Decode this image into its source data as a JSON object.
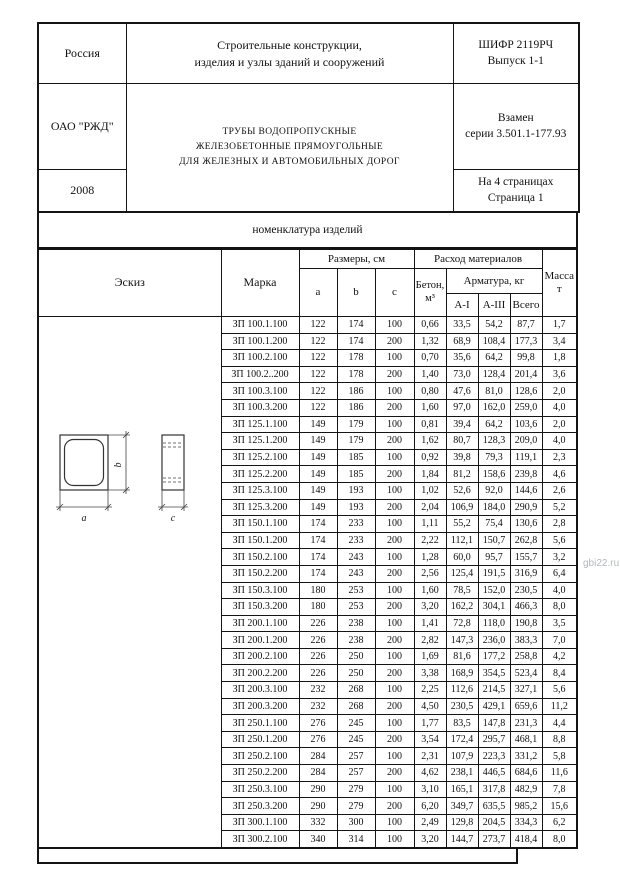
{
  "page": {
    "section_title": "номенклатура изделий",
    "watermark": "gbi22.ru"
  },
  "header": {
    "country": "Россия",
    "category_line1": "Строительные конструкции,",
    "category_line2": "изделия и узлы зданий и сооружений",
    "code_line1": "ШИФР 2119РЧ",
    "code_line2": "Выпуск 1-1",
    "org": "ОАО \"РЖД\"",
    "title_line1": "ТРУБЫ ВОДОПРОПУСКНЫЕ",
    "title_line2": "ЖЕЛЕЗОБЕТОННЫЕ ПРЯМОУГОЛЬНЫЕ",
    "title_line3": "ДЛЯ ЖЕЛЕЗНЫХ И АВТОМОБИЛЬНЫХ ДОРОГ",
    "replaces_line1": "Взамен",
    "replaces_line2": "серии 3.501.1-177.93",
    "year": "2008",
    "pages_line1": "На 4 страницах",
    "pages_line2": "Страница 1"
  },
  "table": {
    "headers": {
      "sketch": "Эскиз",
      "mark": "Марка",
      "dimensions": "Размеры, см",
      "dim_a": "a",
      "dim_b": "b",
      "dim_c": "c",
      "materials": "Расход материалов",
      "concrete_line1": "Бетон,",
      "concrete_line2": "м³",
      "rebar": "Арматура, кг",
      "rebar_a1": "A-I",
      "rebar_a3": "A-III",
      "rebar_total": "Всего",
      "mass_line1": "Масса",
      "mass_line2": "т"
    },
    "sketch_labels": {
      "a": "a",
      "b": "b",
      "c": "c"
    },
    "rows": [
      [
        "ЗП 100.1.100",
        "122",
        "174",
        "100",
        "0,66",
        "33,5",
        "54,2",
        "87,7",
        "1,7"
      ],
      [
        "ЗП 100.1.200",
        "122",
        "174",
        "200",
        "1,32",
        "68,9",
        "108,4",
        "177,3",
        "3,4"
      ],
      [
        "ЗП 100.2.100",
        "122",
        "178",
        "100",
        "0,70",
        "35,6",
        "64,2",
        "99,8",
        "1,8"
      ],
      [
        "ЗП 100.2..200",
        "122",
        "178",
        "200",
        "1,40",
        "73,0",
        "128,4",
        "201,4",
        "3,6"
      ],
      [
        "ЗП 100.3.100",
        "122",
        "186",
        "100",
        "0,80",
        "47,6",
        "81,0",
        "128,6",
        "2,0"
      ],
      [
        "ЗП 100.3.200",
        "122",
        "186",
        "200",
        "1,60",
        "97,0",
        "162,0",
        "259,0",
        "4,0"
      ],
      [
        "ЗП 125.1.100",
        "149",
        "179",
        "100",
        "0,81",
        "39,4",
        "64,2",
        "103,6",
        "2,0"
      ],
      [
        "ЗП 125.1.200",
        "149",
        "179",
        "200",
        "1,62",
        "80,7",
        "128,3",
        "209,0",
        "4,0"
      ],
      [
        "ЗП 125.2.100",
        "149",
        "185",
        "100",
        "0,92",
        "39,8",
        "79,3",
        "119,1",
        "2,3"
      ],
      [
        "ЗП 125.2.200",
        "149",
        "185",
        "200",
        "1,84",
        "81,2",
        "158,6",
        "239,8",
        "4,6"
      ],
      [
        "ЗП 125.3.100",
        "149",
        "193",
        "100",
        "1,02",
        "52,6",
        "92,0",
        "144,6",
        "2,6"
      ],
      [
        "ЗП 125.3.200",
        "149",
        "193",
        "200",
        "2,04",
        "106,9",
        "184,0",
        "290,9",
        "5,2"
      ],
      [
        "ЗП 150.1.100",
        "174",
        "233",
        "100",
        "1,11",
        "55,2",
        "75,4",
        "130,6",
        "2,8"
      ],
      [
        "ЗП 150.1.200",
        "174",
        "233",
        "200",
        "2,22",
        "112,1",
        "150,7",
        "262,8",
        "5,6"
      ],
      [
        "ЗП 150.2.100",
        "174",
        "243",
        "100",
        "1,28",
        "60,0",
        "95,7",
        "155,7",
        "3,2"
      ],
      [
        "ЗП 150.2.200",
        "174",
        "243",
        "200",
        "2,56",
        "125,4",
        "191,5",
        "316,9",
        "6,4"
      ],
      [
        "ЗП 150.3.100",
        "180",
        "253",
        "100",
        "1,60",
        "78,5",
        "152,0",
        "230,5",
        "4,0"
      ],
      [
        "ЗП 150.3.200",
        "180",
        "253",
        "200",
        "3,20",
        "162,2",
        "304,1",
        "466,3",
        "8,0"
      ],
      [
        "ЗП 200.1.100",
        "226",
        "238",
        "100",
        "1,41",
        "72,8",
        "118,0",
        "190,8",
        "3,5"
      ],
      [
        "ЗП 200.1.200",
        "226",
        "238",
        "200",
        "2,82",
        "147,3",
        "236,0",
        "383,3",
        "7,0"
      ],
      [
        "ЗП 200.2.100",
        "226",
        "250",
        "100",
        "1,69",
        "81,6",
        "177,2",
        "258,8",
        "4,2"
      ],
      [
        "ЗП 200.2.200",
        "226",
        "250",
        "200",
        "3,38",
        "168,9",
        "354,5",
        "523,4",
        "8,4"
      ],
      [
        "ЗП 200.3.100",
        "232",
        "268",
        "100",
        "2,25",
        "112,6",
        "214,5",
        "327,1",
        "5,6"
      ],
      [
        "ЗП 200.3.200",
        "232",
        "268",
        "200",
        "4,50",
        "230,5",
        "429,1",
        "659,6",
        "11,2"
      ],
      [
        "ЗП 250.1.100",
        "276",
        "245",
        "100",
        "1,77",
        "83,5",
        "147,8",
        "231,3",
        "4,4"
      ],
      [
        "ЗП 250.1.200",
        "276",
        "245",
        "200",
        "3,54",
        "172,4",
        "295,7",
        "468,1",
        "8,8"
      ],
      [
        "ЗП 250.2.100",
        "284",
        "257",
        "100",
        "2,31",
        "107,9",
        "223,3",
        "331,2",
        "5,8"
      ],
      [
        "ЗП 250.2.200",
        "284",
        "257",
        "200",
        "4,62",
        "238,1",
        "446,5",
        "684,6",
        "11,6"
      ],
      [
        "ЗП 250.3.100",
        "290",
        "279",
        "100",
        "3,10",
        "165,1",
        "317,8",
        "482,9",
        "7,8"
      ],
      [
        "ЗП 250.3.200",
        "290",
        "279",
        "200",
        "6,20",
        "349,7",
        "635,5",
        "985,2",
        "15,6"
      ],
      [
        "ЗП 300.1.100",
        "332",
        "300",
        "100",
        "2,49",
        "129,8",
        "204,5",
        "334,3",
        "6,2"
      ],
      [
        "ЗП 300.2.100",
        "340",
        "314",
        "100",
        "3,20",
        "144,7",
        "273,7",
        "418,4",
        "8,0"
      ]
    ]
  }
}
